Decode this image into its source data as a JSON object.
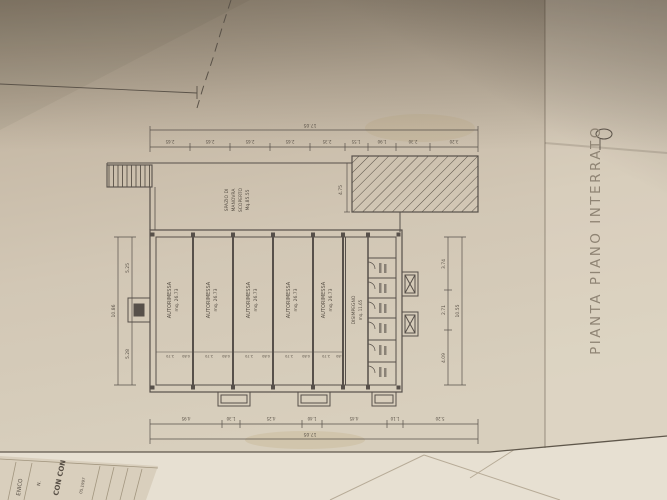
{
  "colors": {
    "paper": "#c9bcaa",
    "paper_right": "#cec1ae",
    "ink": "#57504a",
    "pencil": "#948a7b",
    "under_sheet": "#e7e0d2",
    "dark_surface": "#17130f"
  },
  "title": "PIANTA PIANO INTERRATO",
  "plan": {
    "garages": [
      {
        "name": "AUTORIMESSA",
        "area": "mq. 26.73"
      },
      {
        "name": "AUTORIMESSA",
        "area": "mq. 26.73"
      },
      {
        "name": "AUTORIMESSA",
        "area": "mq. 26.73"
      },
      {
        "name": "AUTORIMESSA",
        "area": "mq. 26.73"
      },
      {
        "name": "AUTORIMESSA",
        "area": "mq. 26.73"
      }
    ],
    "corridor": {
      "name": "DISIMPEGNO",
      "area": "mq. 11.65"
    },
    "maneuver_space": [
      "SPAZIO DI",
      "MANOVRA",
      "SCOPERTO",
      "Mq.85.55"
    ],
    "dims": {
      "top_total": "17.05",
      "top_segments": [
        "2.65",
        "2.65",
        "2.65",
        "2.65",
        "2.35",
        "1.55",
        "1.90",
        "2.30",
        "3.20"
      ],
      "bottom_total": "17.05",
      "bottom_segments": [
        "4.95",
        "1.30",
        "4.25",
        "1.40",
        "4.45",
        "1.10",
        "5.20"
      ],
      "right_segments": [
        "3.74",
        "2.71",
        "4.09"
      ],
      "right_total": "10.55",
      "left_segments": [
        "5.25",
        "5.28"
      ],
      "left_total": "10.86",
      "ramp_depth": "4.75",
      "bay_door": "2.70",
      "bay_pier": "0.80"
    }
  },
  "under_sheet": {
    "fragments": {
      "f1": "CON CON",
      "f2": "ENICO",
      "f3": "N.",
      "f4": "05.1997"
    }
  }
}
